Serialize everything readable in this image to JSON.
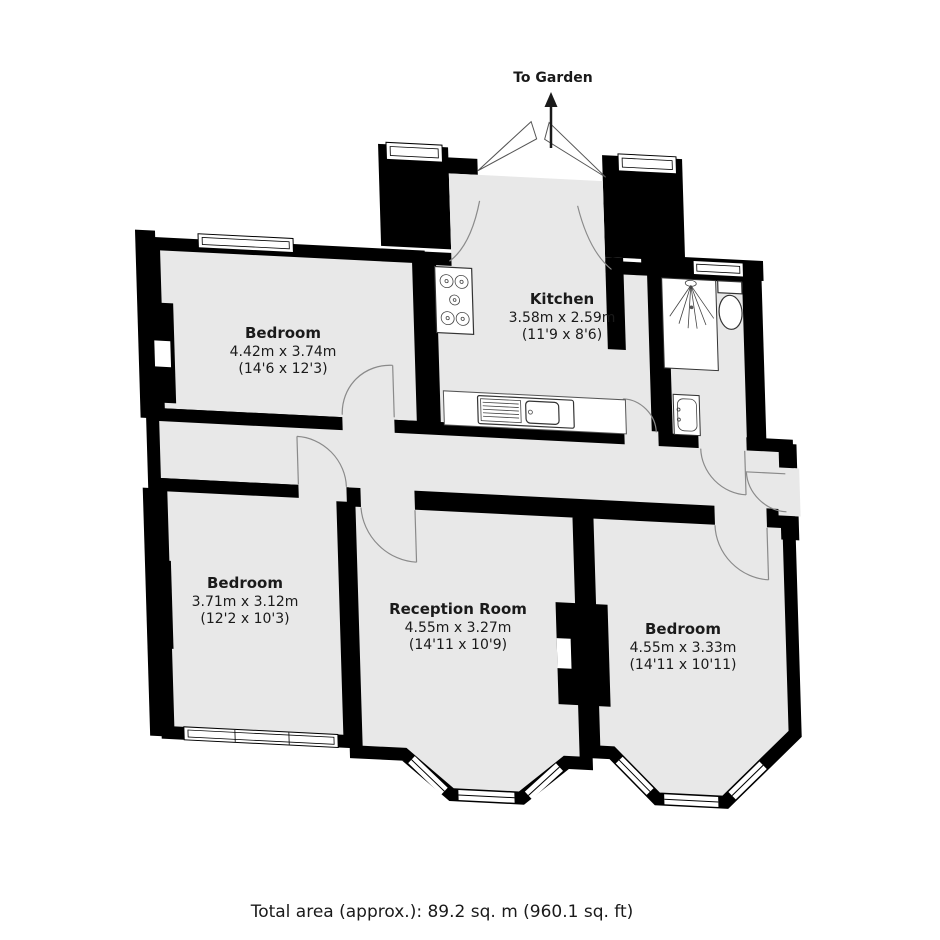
{
  "annotations": {
    "to_garden_label": "To Garden",
    "total_area": "Total area (approx.): 89.2 sq. m (960.1 sq. ft)"
  },
  "rooms": [
    {
      "name": "Bedroom",
      "size_m": "4.42m x 3.74m",
      "size_ft": "(14'6 x 12'3)"
    },
    {
      "name": "Kitchen",
      "size_m": "3.58m x 2.59m",
      "size_ft": "(11'9 x 8'6)"
    },
    {
      "name": "Bedroom",
      "size_m": "3.71m x 3.12m",
      "size_ft": "(12'2 x 10'3)"
    },
    {
      "name": "Reception Room",
      "size_m": "4.55m x 3.27m",
      "size_ft": "(14'11 x 10'9)"
    },
    {
      "name": "Bedroom",
      "size_m": "4.55m x 3.33m",
      "size_ft": "(14'11 x 10'11)"
    }
  ],
  "fixtures": [
    "hob",
    "sink",
    "shower",
    "toilet",
    "basin",
    "fireplace"
  ],
  "colors": {
    "floor": "#e8e8e8",
    "wall": "#000000",
    "door_arc": "#8a8a8a",
    "text": "#1a1a1a"
  }
}
